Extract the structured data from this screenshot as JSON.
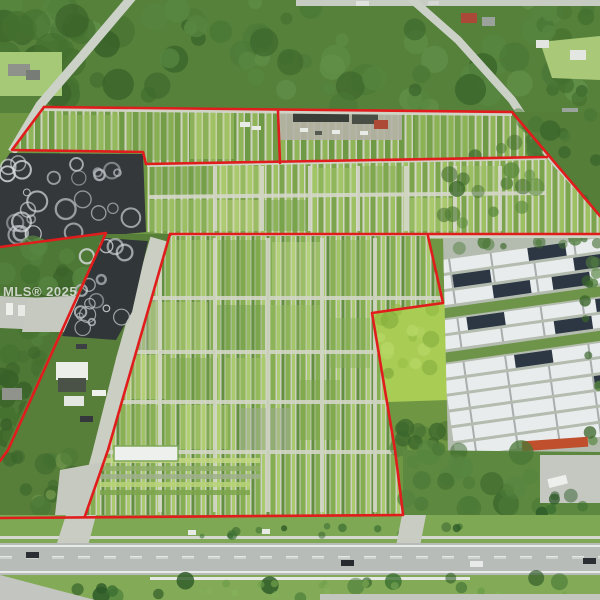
{
  "meta": {
    "type": "aerial-photograph",
    "subject": "Aerial drone view of plant nursery farmland outlined with a red property boundary, fronting a multi-lane highway",
    "canvas": "600x600"
  },
  "watermark": {
    "text": "MLS® 2025"
  },
  "palette": {
    "boundary_red": "#e01c1c",
    "field_green": "#7da550",
    "row_light_green": "#9dc063",
    "row_dark_green": "#6f9a45",
    "path_gray": "#d2d6c6",
    "shade_cloth_dark": "#34383b",
    "shade_swirl_white": "#d8dcde",
    "greenhouse_white": "#e9eced",
    "greenhouse_dark_panel": "#2c3743",
    "highway_gray": "#b8bcb8",
    "median_green": "#83aa56",
    "tree_dark_green": "#3c672c",
    "farm_roof_red": "#ad4a36",
    "driveway_gray": "#c9ccc3"
  },
  "features": [
    "red property boundary outline with internal lot lines",
    "north nursery parcel with crop rows and farm buildings",
    "middle nursery parcel with grid of planting blocks",
    "south nursery parcel with planting blocks and white greenhouse",
    "two dark shade-cloth houses with white swirl patterns (excluded lots)",
    "garden-center driveway strip with white canopy tent (excluded lot)",
    "white-and-dark greenhouse complex to the east (neighboring nursery)",
    "diagonal rural roads to the northwest and northeast",
    "multi-lane highway with grass median and palm trees along the bottom",
    "cars on highway, box trucks in staging yards"
  ]
}
